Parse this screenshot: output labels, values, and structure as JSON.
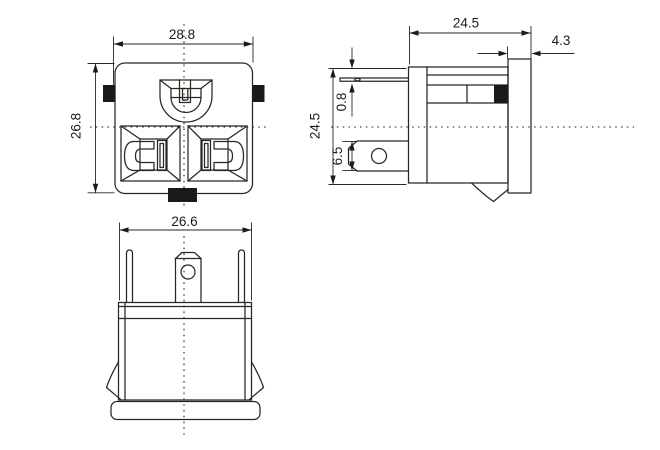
{
  "colors": {
    "line": "#2a2620",
    "fill_black": "#111111",
    "background": "#ffffff"
  },
  "dims": {
    "front_width": "28.8",
    "front_height": "26.8",
    "bottom_width": "26.6",
    "side_depth": "24.5",
    "side_height": "24.5",
    "flange_thickness": "4.3",
    "pin_thickness": "0.8",
    "terminal_height": "6.5"
  }
}
